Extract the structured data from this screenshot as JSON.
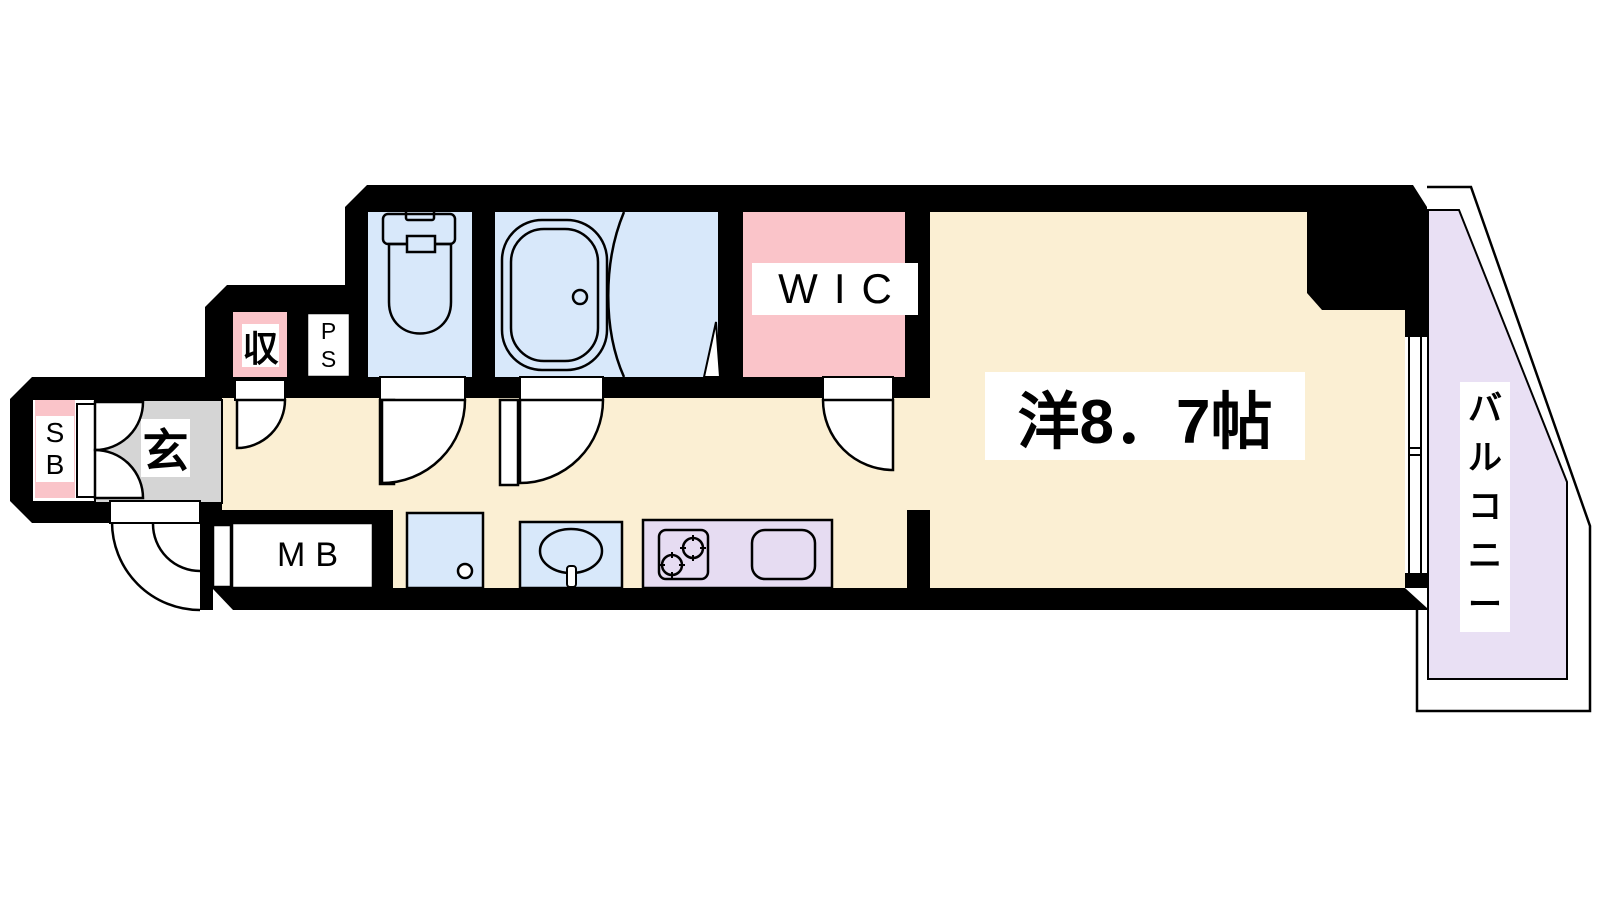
{
  "plan": {
    "type": "apartment-floor-plan",
    "rooms": {
      "main_room": {
        "label": "洋8．7帖"
      },
      "wic": {
        "label": "WIC"
      },
      "balcony": {
        "chars": [
          "バ",
          "ル",
          "コ",
          "ニ",
          "ー"
        ]
      },
      "genkan": {
        "label": "玄"
      },
      "storage": {
        "label": "収"
      },
      "shoe_box": {
        "line1": "S",
        "line2": "B"
      },
      "pipe_space": {
        "line1": "P",
        "line2": "S"
      },
      "meter_box": {
        "label": "MB"
      }
    },
    "colors": {
      "wall": "#000000",
      "floor_cream": "#FBEFD3",
      "water_blue": "#D8E8FA",
      "closet_pink": "#FAC4C9",
      "kitchen_purple": "#E6DCF2",
      "balcony_purple": "#E9E0F4",
      "genkan_gray": "#D5D5D5",
      "label_bg": "#FFFFFF",
      "line": "#000000"
    }
  }
}
